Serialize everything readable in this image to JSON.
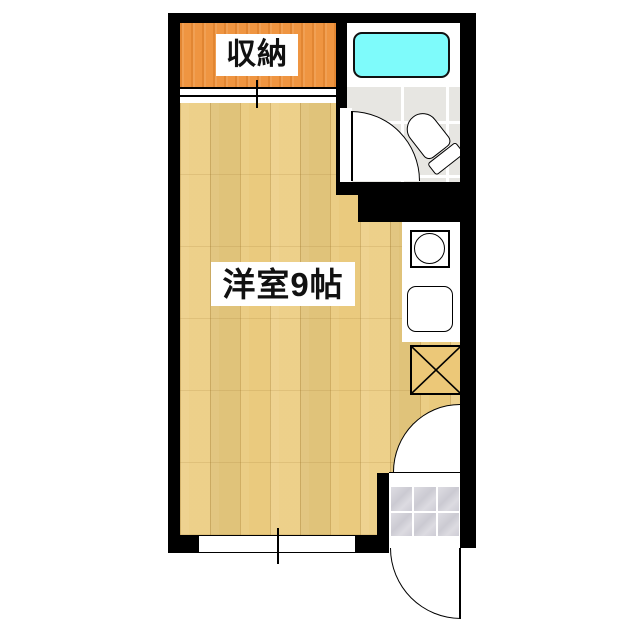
{
  "floorplan": {
    "type": "apartment-floor-plan",
    "labels": {
      "closet": "収納",
      "main_room": "洋室9帖"
    },
    "rooms": [
      "closet",
      "western-room-9-tatami",
      "bathroom",
      "kitchen",
      "entrance"
    ],
    "fixtures": [
      "bathtub",
      "toilet",
      "stove-burner",
      "kitchen-sink",
      "appliance-space",
      "sliding-closet-door",
      "bathroom-door",
      "entrance-inner-door",
      "entrance-exterior-door",
      "window",
      "entrance-tiles"
    ],
    "colors": {
      "wall": "#000000",
      "wood_floor": "#eccd81",
      "closet": "#ef9541",
      "bathtub": "#7efbfb",
      "bath_tile": "#e7e6e2",
      "genkan_tile": "#d3d2d8",
      "background": "#ffffff"
    }
  }
}
